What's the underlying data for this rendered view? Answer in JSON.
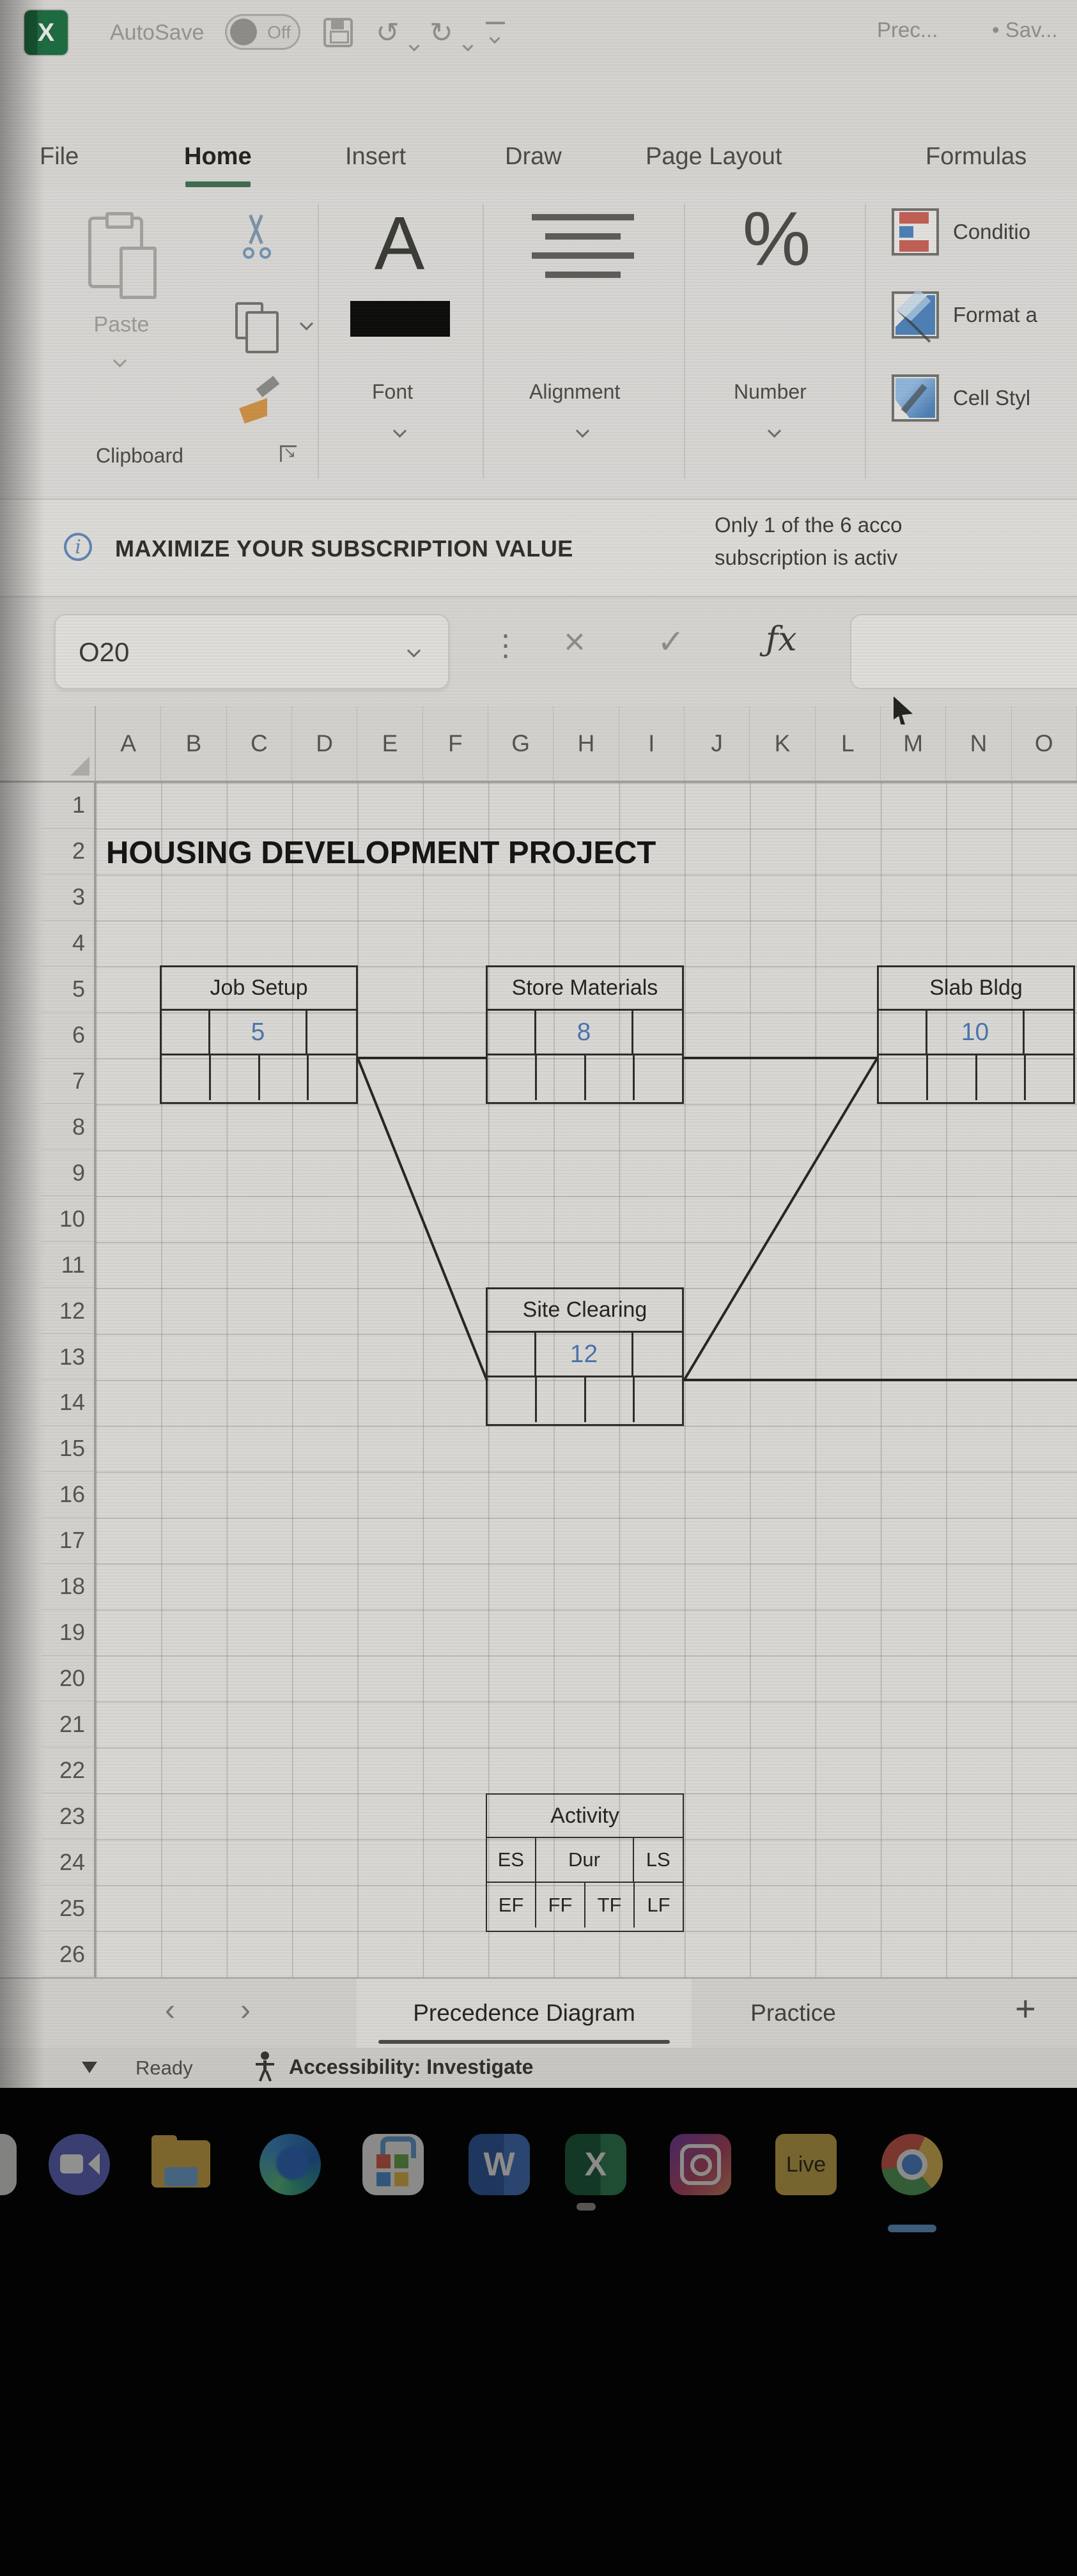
{
  "titlebar": {
    "app_letter": "X",
    "autosave_label": "AutoSave",
    "autosave_state": "Off",
    "doc_title": "Prec...",
    "save_status": "• Sav..."
  },
  "ribbon": {
    "tabs": [
      {
        "label": "File",
        "active": false
      },
      {
        "label": "Home",
        "active": true
      },
      {
        "label": "Insert",
        "active": false
      },
      {
        "label": "Draw",
        "active": false
      },
      {
        "label": "Page Layout",
        "active": false
      },
      {
        "label": "Formulas",
        "active": false
      }
    ],
    "clipboard": {
      "paste_label": "Paste",
      "group_label": "Clipboard"
    },
    "font": {
      "icon_glyph": "A",
      "group_label": "Font"
    },
    "alignment": {
      "group_label": "Alignment"
    },
    "number": {
      "icon_glyph": "%",
      "group_label": "Number"
    },
    "styles": {
      "conditional_label": "Conditio",
      "format_as_label": "Format a",
      "cell_styles_label": "Cell Styl"
    }
  },
  "message_bar": {
    "info_glyph": "i",
    "title": "MAXIMIZE YOUR SUBSCRIPTION VALUE",
    "detail_line1": "Only 1 of the 6 acco",
    "detail_line2": "subscription is activ"
  },
  "formula_bar": {
    "name_box": "O20",
    "dots_glyph": "⋮",
    "cancel_glyph": "×",
    "enter_glyph": "✓",
    "fx_glyph": "ƒx"
  },
  "grid": {
    "columns": [
      "A",
      "B",
      "C",
      "D",
      "E",
      "F",
      "G",
      "H",
      "I",
      "J",
      "K",
      "L",
      "M",
      "N",
      "O"
    ],
    "rows": [
      "1",
      "2",
      "3",
      "4",
      "5",
      "6",
      "7",
      "8",
      "9",
      "10",
      "11",
      "12",
      "13",
      "14",
      "15",
      "16",
      "17",
      "18",
      "19",
      "20",
      "21",
      "22",
      "23",
      "24",
      "25",
      "26"
    ]
  },
  "sheet": {
    "title_cell": "HOUSING DEVELOPMENT PROJECT"
  },
  "diagram": {
    "nodes": [
      {
        "name": "Job Setup",
        "duration": "5"
      },
      {
        "name": "Store Materials",
        "duration": "8"
      },
      {
        "name": "Slab Bldg",
        "duration": "10"
      },
      {
        "name": "Site Clearing",
        "duration": "12"
      }
    ],
    "edges": [
      "Job Setup → Site Clearing",
      "Slab Bldg → Site Clearing",
      "Job Setup — Store Materials",
      "Store Materials — Slab Bldg",
      "Site Clearing → (off-screen right)"
    ],
    "legend": {
      "title": "Activity",
      "mid_cells": [
        "ES",
        "Dur",
        "LS"
      ],
      "bottom_cells": [
        "EF",
        "FF",
        "TF",
        "LF"
      ]
    }
  },
  "sheet_tabs": {
    "prev_glyph": "‹",
    "next_glyph": "›",
    "active_tab": "Precedence Diagram",
    "inactive_tab": "Practice",
    "add_glyph": "+"
  },
  "status_bar": {
    "ready": "Ready",
    "accessibility": "Accessibility: Investigate"
  },
  "taskbar": {
    "word_letter": "W",
    "excel_letter": "X",
    "live_label": "Live",
    "icons": [
      "partial-app",
      "video-call",
      "file-explorer",
      "edge",
      "microsoft-store",
      "word",
      "excel",
      "instagram",
      "ableton-live",
      "chrome"
    ]
  },
  "colors": {
    "excel_green": "#1d6b40",
    "home_underline_green": "#3e6b4f",
    "duration_blue": "#4a74ae",
    "taskbar_black": "#030303"
  }
}
